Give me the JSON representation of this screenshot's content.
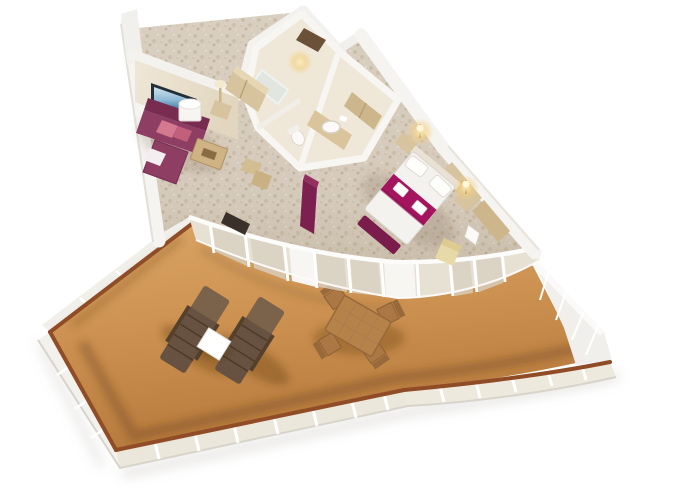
{
  "image": {
    "type": "3d-cutaway-floorplan-render",
    "subject": "Cruise ship suite with wraparound private balcony, viewed from above at an angle",
    "rooms": [
      "living-room",
      "entry-hall",
      "bathroom",
      "bedroom",
      "balcony"
    ],
    "living_room": [
      "magenta sectional sofa with pink pillows",
      "wall TV with ocean picture",
      "white drum lamp",
      "wood coffee table",
      "wood side chairs",
      "tall wood closet"
    ],
    "bathroom": [
      "round white sink on wood vanity",
      "toilet",
      "shower"
    ],
    "bedroom": [
      "white double bed with magenta runner and folded towels",
      "magenta foot bench",
      "two nightstands with lit lamps",
      "wood wardrobe",
      "cream armchair",
      "magenta pillar"
    ],
    "balcony": [
      "wood deck",
      "two brown sun loungers",
      "white side table",
      "wood dining table with four chairs",
      "glass railing with brown wood handrail and white posts"
    ]
  },
  "colors": {
    "background": "#ffffff",
    "deck_light": "#dba566",
    "deck": "#cc9150",
    "deck_dark": "#b67a3c",
    "handrail": "#8f4c26",
    "railing_white": "#f3f1ec",
    "glass_outer": "#ece7db",
    "base_edge": "#d8d4cb",
    "ne_wall": "#f1efeb",
    "carpet": "#d9cfc1",
    "carpet_fleck": "#c8baa4",
    "glass_wall": "#e7e1d4",
    "glass_pane": "#d8cfbf",
    "wall_white": "#f5f4f1",
    "wall_edge": "#e0ddd7",
    "wall_cream": "#efe7d7",
    "bath_floor": "#efe8d9",
    "wood": "#d7c49e",
    "wood_dark": "#cdb68c",
    "wood_deep": "#6b5138",
    "tv_frame": "#232f38",
    "sofa": "#8e3d63",
    "sofa_dark": "#772c50",
    "pillow_a": "#d4798f",
    "pillow_b": "#c2607c",
    "throw": "#f4eef0",
    "lamp_white": "#f6f5f2",
    "coffee_table": "#cfb384",
    "dark_cabinet": "#3a322a",
    "pillar": "#7c2050",
    "bed": "#f4f2ee",
    "runner": "#a5145f",
    "bench": "#7a1c4c",
    "yellow_chair": "#e8d9a8",
    "vanity": "#d9c49c",
    "fixture_white": "#fbfaf8",
    "glow": "#f3cf7e",
    "lounger": "#675241",
    "lounger_back": "#7b624a",
    "patio_table": "#ffffff",
    "dining_wood": "#b5834a",
    "dining_wood_dark": "#97693a",
    "chair_wood": "#ab7845"
  }
}
